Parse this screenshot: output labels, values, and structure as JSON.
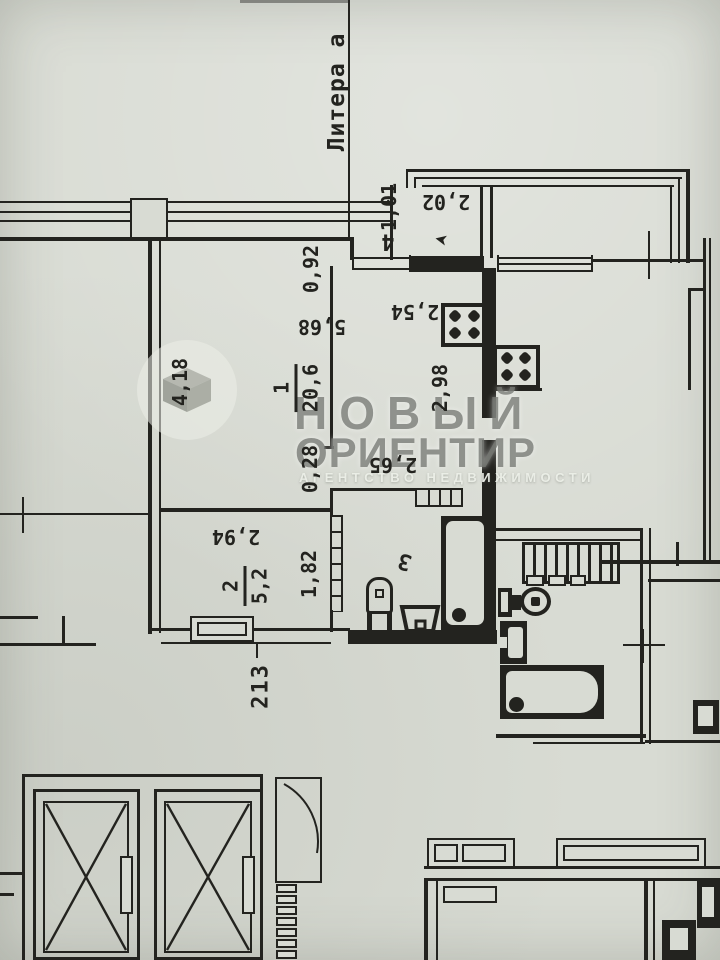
{
  "meta": {
    "document_type": "floor-plan-photo",
    "litera_label": "Литера а"
  },
  "watermark": {
    "brand_line1": "НОВЫЙ",
    "brand_line2": "ОРИЕНТИР",
    "brand_line3": "АГЕНТСТВО НЕДВИЖИМОСТИ",
    "logo_icon": "open-box-icon",
    "brand_color": "#787b73"
  },
  "rooms": [
    {
      "id": "room-1",
      "number": "1",
      "area": "20,6"
    },
    {
      "id": "room-2",
      "number": "2",
      "area": "5,2"
    },
    {
      "id": "room-3",
      "number": "3"
    },
    {
      "id": "room-4",
      "number": "4"
    }
  ],
  "dimensions": {
    "balcony_width": "2,02",
    "balcony_depth": "1,01",
    "entry_niche": "0,92",
    "living_length": "5,68",
    "living_width": "4,18",
    "kitchen_width": "2,54",
    "kitchen_depth": "2,98",
    "corridor_step": "0,28",
    "corridor_length": "2,65",
    "room2_width": "2,94",
    "room2_height": "1,82",
    "floor_mark": "213"
  },
  "icons": {
    "entrance_arrow": "➤"
  },
  "colors": {
    "paper": "#d8dbd3",
    "ink": "#23231f",
    "watermark": "#787b73"
  }
}
